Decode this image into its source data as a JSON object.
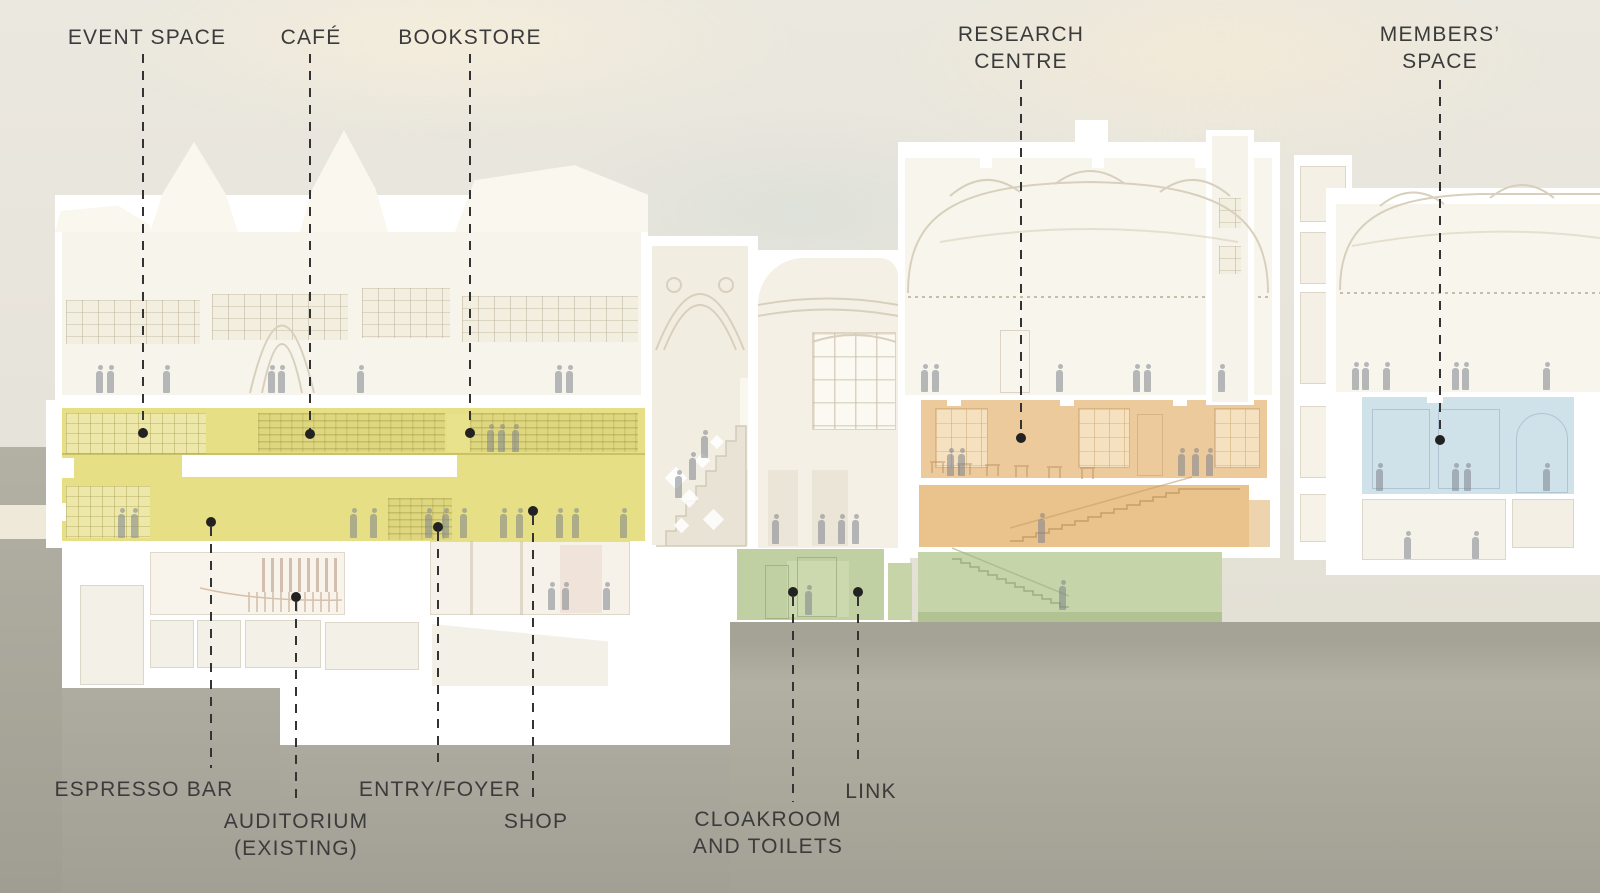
{
  "diagram": {
    "type": "architectural-cross-section",
    "description": "Cutaway long-section of a building with colour-coded programme zones, dashed leader lines and room labels"
  },
  "labels": {
    "event_space": "EVENT SPACE",
    "cafe": "CAFÉ",
    "bookstore": "BOOKSTORE",
    "research_centre": "RESEARCH\nCENTRE",
    "members_space": "MEMBERS’\nSPACE",
    "espresso_bar": "ESPRESSO BAR",
    "auditorium_existing": "AUDITORIUM\n(EXISTING)",
    "entry_foyer": "ENTRY/FOYER",
    "shop": "SHOP",
    "cloakroom_toilets": "CLOAKROOM\nAND TOILETS",
    "link": "LINK"
  },
  "zones": [
    {
      "name": "Event space / Café / Bookstore / Espresso bar / Entry-foyer / Shop",
      "color": "#e6df85"
    },
    {
      "name": "Research Centre",
      "color": "#ecca9c"
    },
    {
      "name": "Members’ Space",
      "color": "#cfe1e9"
    },
    {
      "name": "Link / Cloakroom and toilets",
      "color": "#c2d2a3"
    }
  ],
  "colors": {
    "label_text": "#3b3b3b",
    "leader_line": "#333333",
    "sky": "#e9e6dd",
    "ground": "#aaa89b",
    "ghost_building": "#f7f4eb"
  }
}
